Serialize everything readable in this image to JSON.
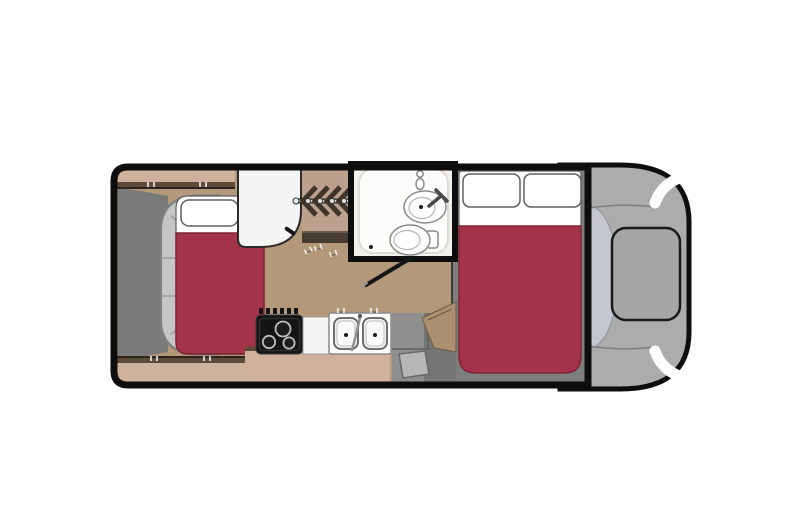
{
  "floorplan": {
    "type": "motorhome-top-view-floorplan",
    "orientation": "cab-on-right",
    "colors": {
      "outline": "#0e0e0e",
      "floor": "#b3997a",
      "cabinet": "#cfb29d",
      "cabinet_edge": "#5c4a3b",
      "cabinet_kitchen": "#d0b19b",
      "wardrobe_bg": "#bda08e",
      "hanger": "#3f352b",
      "shelf_dark": "#473c31",
      "bed_red": "#a43349",
      "bed_red_edge": "#7c2636",
      "white": "#fdfdfd",
      "sofa": "#c6c5c5",
      "sofa_edge": "#7f7f7f",
      "rear_wall": "#7a7a7a",
      "bedframe": "#7e7e7e",
      "stove": "#141414",
      "burner_ring": "#bdbdbd",
      "counter": "#f5f5f5",
      "sink_edge": "#5f5f5f",
      "entry_gray": "#8f8f8f",
      "entry_dark": "#757575",
      "mat": "#b7b7b7",
      "wedge_tan": "#aa906f",
      "bath_wall": "#0d0d0d",
      "bath_floor": "#f2f0ed",
      "bath_panel": "#fcfcfb",
      "cab_body": "#acacac",
      "hood": "#a6a6a6",
      "windshield": "#c4c6d0",
      "headlight": "#fdfdfd"
    },
    "areas": [
      {
        "id": "rear-corner-bed",
        "label": "rear corner bed with pillow and red bedding"
      },
      {
        "id": "wraparound-sofa",
        "label": "gray wraparound seat frame"
      },
      {
        "id": "overhead-cabinets",
        "label": "tan overhead cabinets"
      },
      {
        "id": "refrigerator",
        "label": "refrigerator"
      },
      {
        "id": "wardrobe",
        "label": "wardrobe with clothes hangers"
      },
      {
        "id": "wet-bath",
        "label": "wet bath with shower head, sink and toilet"
      },
      {
        "id": "kitchen",
        "label": "kitchen with 3-burner cooktop and double sink"
      },
      {
        "id": "entry-step",
        "label": "entry step with floor mat"
      },
      {
        "id": "main-bed",
        "label": "main double bed with two pillows and red bedding"
      },
      {
        "id": "cab",
        "label": "driver cab with windshield, hood and headlights"
      }
    ]
  }
}
